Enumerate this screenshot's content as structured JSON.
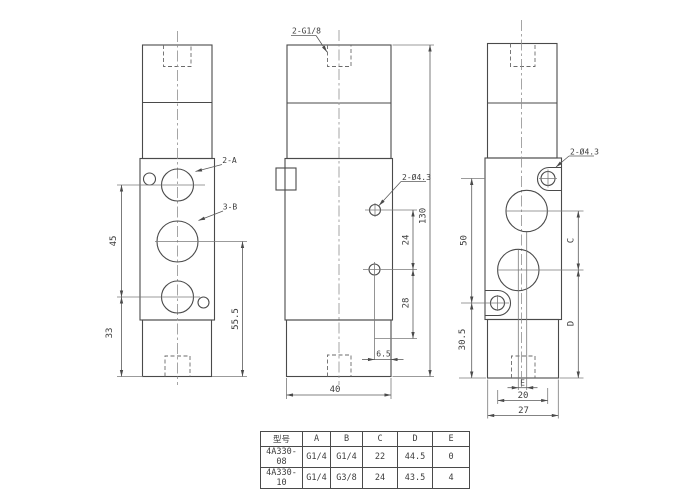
{
  "views": {
    "front": {
      "labels": {
        "port_a": "2-A",
        "port_b": "3-B"
      },
      "dims": {
        "port_spacing": "45",
        "port_to_base": "33",
        "body_height": "55.5"
      }
    },
    "side": {
      "labels": {
        "top_ports": "2-G1/8",
        "mounting_holes": "2-Ø4.3"
      },
      "dims": {
        "hole_spacing": "24",
        "hole_to_base": "28",
        "hole_offset": "6.5",
        "base_width": "40",
        "total_height": "130"
      }
    },
    "rear": {
      "labels": {
        "mounting_holes": "2-Ø4.3"
      },
      "dims": {
        "hole_span": "50",
        "base_height": "30.5",
        "dim_c": "C",
        "dim_d": "D",
        "dim_e": "E",
        "hole_spacing_h": "20",
        "base_width": "27"
      }
    }
  },
  "table": {
    "headers": [
      "型号",
      "A",
      "B",
      "C",
      "D",
      "E"
    ],
    "rows": [
      [
        "4A330-08",
        "G1/4",
        "G1/4",
        "22",
        "44.5",
        "0"
      ],
      [
        "4A330-10",
        "G1/4",
        "G3/8",
        "24",
        "43.5",
        "4"
      ]
    ]
  },
  "colors": {
    "line": "#4a4a4a",
    "background": "#ffffff"
  }
}
